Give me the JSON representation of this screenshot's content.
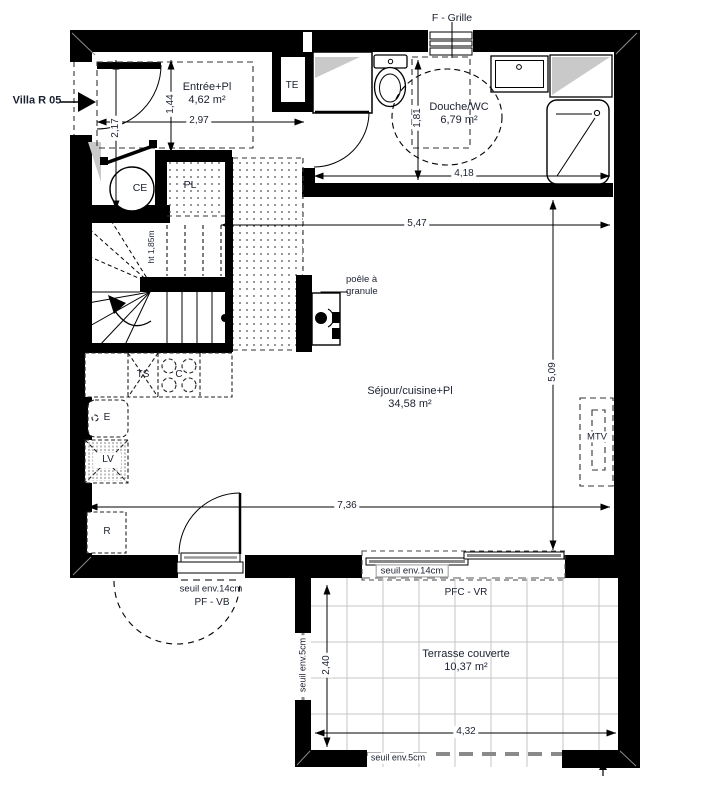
{
  "title": "Villa R 05",
  "annotations": {
    "grille": "F - Grille",
    "te": "TE",
    "ce": "CE",
    "pl": "PL",
    "stair_height": "ht 1,85m",
    "stove": "poêle à granule",
    "mtv": "MTV",
    "kitchen": {
      "ts": "TS",
      "c": "C",
      "e": "E",
      "lv": "LV",
      "r": "R"
    },
    "door_sill": "seuil env.14cm",
    "door_type": "PF - VB",
    "bay_sill": "seuil env.14cm",
    "bay_type": "PFC - VR",
    "terrace_sill_left": "seuil env.5cm",
    "terrace_sill_bottom": "seuil env.5cm"
  },
  "rooms": {
    "entree": {
      "name": "Entrée+Pl",
      "area": "4,62 m²"
    },
    "douche": {
      "name": "Douche/WC",
      "area": "6,79 m²"
    },
    "sejour": {
      "name": "Séjour/cuisine+Pl",
      "area": "34,58 m²"
    },
    "terrasse": {
      "name": "Terrasse couverte",
      "area": "10,37 m²"
    }
  },
  "dimensions": {
    "entree_width": "2,97",
    "entree_depth": "1,44",
    "entry_side": "2,17",
    "bath_width": "4,18",
    "bath_depth": "1,81",
    "sejour_top": "5,47",
    "sejour_height": "5,09",
    "sejour_width": "7,36",
    "terrace_depth": "2,40",
    "terrace_width": "4,32"
  },
  "colors": {
    "wall": "#000000",
    "text": "#1b2130",
    "shaft_grey": "#c9c9c9",
    "tile_grey": "#c5c5c5",
    "open_edge_grey": "#8a8a8a"
  }
}
